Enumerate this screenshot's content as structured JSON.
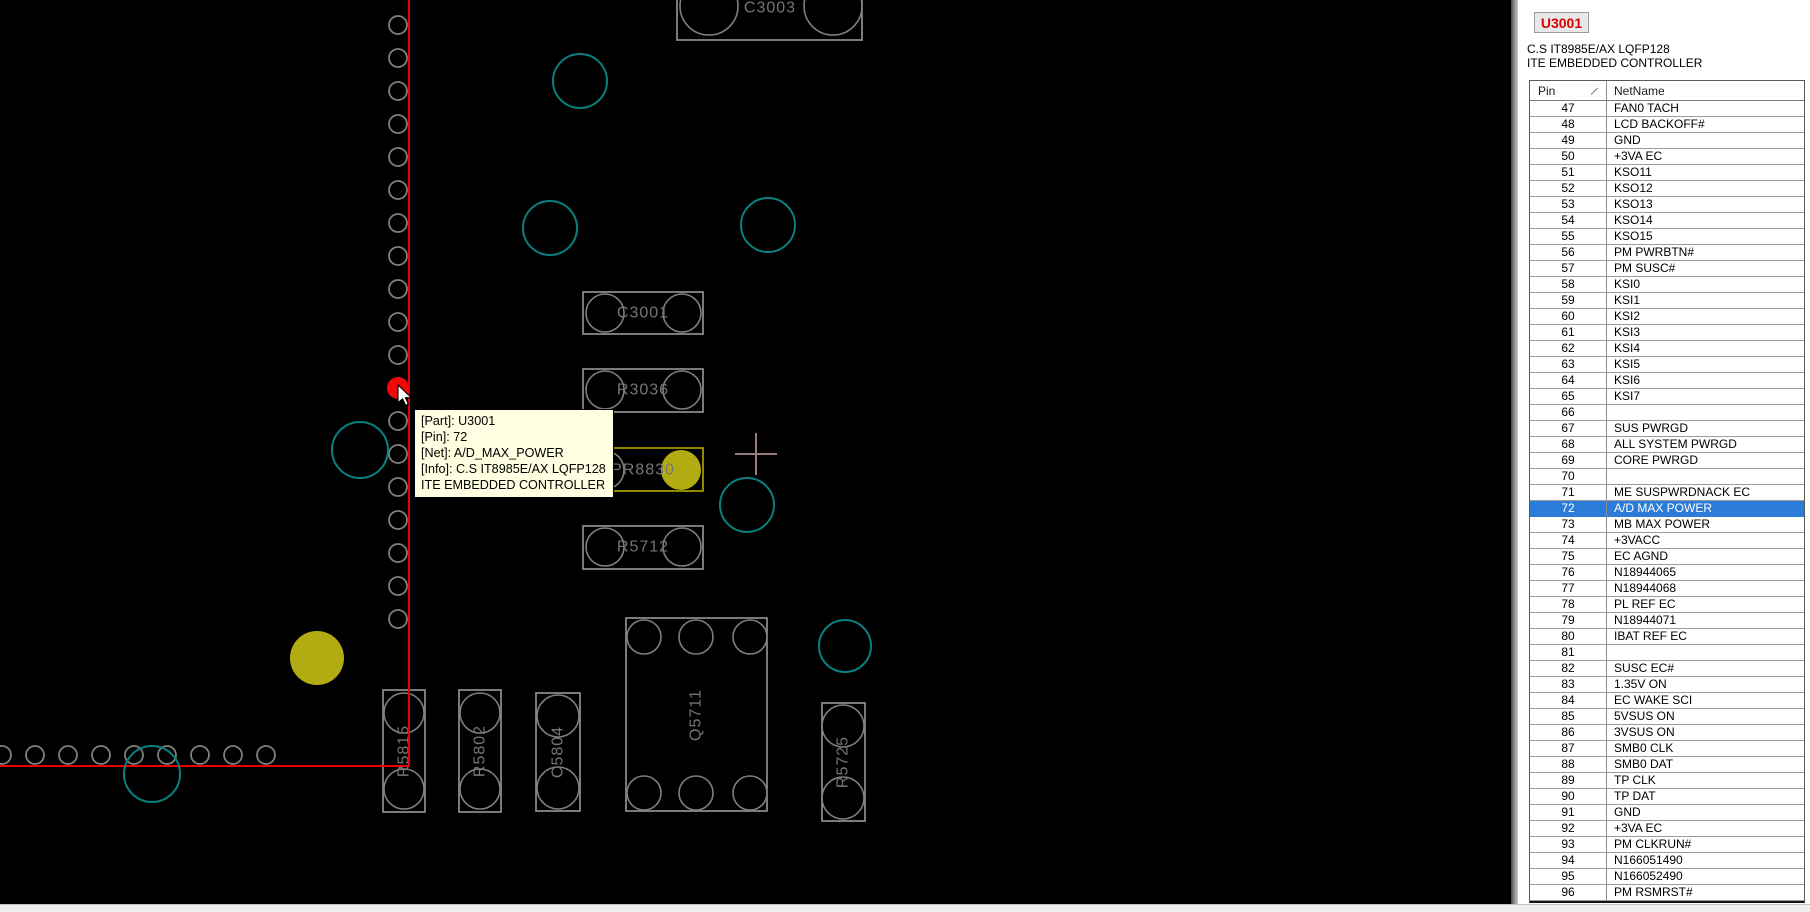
{
  "tooltip": {
    "lines": [
      "[Part]: U3001",
      "[Pin]: 72",
      "[Net]: A/D_MAX_POWER",
      "[Info]: C.S IT8985E/AX LQFP128",
      "ITE EMBEDDED CONTROLLER"
    ]
  },
  "panel": {
    "part_button_label": "U3001",
    "part_info": [
      "C.S IT8985E/AX LQFP128",
      "ITE EMBEDDED CONTROLLER"
    ],
    "table": {
      "columns": [
        "Pin",
        "NetName"
      ],
      "selected_pin": "72",
      "selection_color": "#2b7bd8",
      "rows": [
        {
          "pin": "47",
          "net": "FAN0 TACH"
        },
        {
          "pin": "48",
          "net": "LCD BACKOFF#"
        },
        {
          "pin": "49",
          "net": "GND"
        },
        {
          "pin": "50",
          "net": "+3VA EC"
        },
        {
          "pin": "51",
          "net": "KSO11"
        },
        {
          "pin": "52",
          "net": "KSO12"
        },
        {
          "pin": "53",
          "net": "KSO13"
        },
        {
          "pin": "54",
          "net": "KSO14"
        },
        {
          "pin": "55",
          "net": "KSO15"
        },
        {
          "pin": "56",
          "net": "PM PWRBTN#"
        },
        {
          "pin": "57",
          "net": "PM SUSC#"
        },
        {
          "pin": "58",
          "net": "KSI0"
        },
        {
          "pin": "59",
          "net": "KSI1"
        },
        {
          "pin": "60",
          "net": "KSI2"
        },
        {
          "pin": "61",
          "net": "KSI3"
        },
        {
          "pin": "62",
          "net": "KSI4"
        },
        {
          "pin": "63",
          "net": "KSI5"
        },
        {
          "pin": "64",
          "net": "KSI6"
        },
        {
          "pin": "65",
          "net": "KSI7"
        },
        {
          "pin": "66",
          "net": ""
        },
        {
          "pin": "67",
          "net": "SUS PWRGD"
        },
        {
          "pin": "68",
          "net": "ALL SYSTEM PWRGD"
        },
        {
          "pin": "69",
          "net": "CORE PWRGD"
        },
        {
          "pin": "70",
          "net": ""
        },
        {
          "pin": "71",
          "net": "ME SUSPWRDNACK EC"
        },
        {
          "pin": "72",
          "net": "A/D MAX POWER"
        },
        {
          "pin": "73",
          "net": "MB MAX POWER"
        },
        {
          "pin": "74",
          "net": "+3VACC"
        },
        {
          "pin": "75",
          "net": "EC AGND"
        },
        {
          "pin": "76",
          "net": "N18944065"
        },
        {
          "pin": "77",
          "net": "N18944068"
        },
        {
          "pin": "78",
          "net": "PL REF EC"
        },
        {
          "pin": "79",
          "net": "N18944071"
        },
        {
          "pin": "80",
          "net": "IBAT REF EC"
        },
        {
          "pin": "81",
          "net": ""
        },
        {
          "pin": "82",
          "net": "SUSC EC#"
        },
        {
          "pin": "83",
          "net": "1.35V ON"
        },
        {
          "pin": "84",
          "net": "EC WAKE SCI"
        },
        {
          "pin": "85",
          "net": "5VSUS ON"
        },
        {
          "pin": "86",
          "net": "3VSUS ON"
        },
        {
          "pin": "87",
          "net": "SMB0 CLK"
        },
        {
          "pin": "88",
          "net": "SMB0 DAT"
        },
        {
          "pin": "89",
          "net": "TP CLK"
        },
        {
          "pin": "90",
          "net": "TP DAT"
        },
        {
          "pin": "91",
          "net": "GND"
        },
        {
          "pin": "92",
          "net": "+3VA EC"
        },
        {
          "pin": "93",
          "net": "PM CLKRUN#"
        },
        {
          "pin": "94",
          "net": "N166051490"
        },
        {
          "pin": "95",
          "net": "N166052490"
        },
        {
          "pin": "96",
          "net": "PM RSMRST#"
        }
      ]
    }
  },
  "board": {
    "colors": {
      "bg": "#000000",
      "pad": "#7f7f7f",
      "outline": "#8f8f8f",
      "label": "#767676",
      "via": "#0a8080",
      "red": "#e60000",
      "red_dot": "#ee0a0a",
      "yellow": "#b3ab12",
      "yellow_outline": "#a6a000",
      "crosshair": "#9a7b7b"
    },
    "components": [
      {
        "ref": "C3003",
        "x": 677,
        "y": -25,
        "w": 185,
        "h": 65,
        "rot": 0,
        "label": [
          770,
          8
        ],
        "pads": [
          [
            709,
            6,
            29
          ],
          [
            833,
            6,
            29
          ]
        ]
      },
      {
        "ref": "C3001",
        "x": 583,
        "y": 292,
        "w": 120,
        "h": 42,
        "rot": 0,
        "label": [
          643,
          313
        ],
        "pads": [
          [
            605,
            313,
            19
          ],
          [
            682,
            313,
            19
          ]
        ]
      },
      {
        "ref": "R3036",
        "x": 583,
        "y": 369,
        "w": 120,
        "h": 43,
        "rot": 0,
        "label": [
          643,
          390
        ],
        "pads": [
          [
            605,
            390,
            19
          ],
          [
            682,
            390,
            19
          ]
        ]
      },
      {
        "ref": "PR8830",
        "x": 583,
        "y": 448,
        "w": 120,
        "h": 43,
        "rot": 0,
        "label": [
          643,
          470
        ],
        "highlight": true,
        "pads": [
          [
            605,
            470,
            19
          ],
          [
            681,
            470,
            20,
            "y"
          ]
        ]
      },
      {
        "ref": "R5712",
        "x": 583,
        "y": 526,
        "w": 120,
        "h": 43,
        "rot": 0,
        "label": [
          643,
          547
        ],
        "pads": [
          [
            605,
            547,
            19
          ],
          [
            682,
            547,
            19
          ]
        ]
      },
      {
        "ref": "Q5711",
        "x": 626,
        "y": 618,
        "w": 141,
        "h": 193,
        "rot": -90,
        "label": [
          696,
          715
        ],
        "pads": [
          [
            644,
            637,
            17
          ],
          [
            696,
            637,
            17
          ],
          [
            750,
            637,
            17
          ],
          [
            644,
            793,
            17
          ],
          [
            696,
            793,
            17
          ],
          [
            750,
            793,
            17
          ]
        ]
      },
      {
        "ref": "R5815",
        "x": 383,
        "y": 690,
        "w": 42,
        "h": 122,
        "rot": -90,
        "label": [
          404,
          751
        ],
        "pads": [
          [
            404,
            713,
            20
          ],
          [
            404,
            789,
            20
          ]
        ]
      },
      {
        "ref": "R5802",
        "x": 459,
        "y": 690,
        "w": 42,
        "h": 122,
        "rot": -90,
        "label": [
          480,
          751
        ],
        "pads": [
          [
            480,
            713,
            20
          ],
          [
            480,
            789,
            20
          ]
        ]
      },
      {
        "ref": "C5804",
        "x": 536,
        "y": 693,
        "w": 44,
        "h": 118,
        "rot": -90,
        "label": [
          558,
          752
        ],
        "pads": [
          [
            558,
            716,
            21
          ],
          [
            558,
            788,
            21
          ]
        ]
      },
      {
        "ref": "R5725",
        "x": 822,
        "y": 703,
        "w": 43,
        "h": 118,
        "rot": -90,
        "label": [
          843,
          762
        ],
        "pads": [
          [
            843,
            726,
            21
          ],
          [
            843,
            798,
            21
          ]
        ]
      }
    ],
    "pad_column": {
      "x": 398,
      "y0": 25,
      "dy": 33,
      "n": 19,
      "r": 9,
      "red_index": 11
    },
    "pad_row": {
      "y": 755,
      "x0": 2,
      "dx": 33,
      "n": 9,
      "r": 9
    },
    "red_lines": [
      [
        409,
        0,
        409,
        766
      ],
      [
        0,
        766,
        409,
        766
      ]
    ],
    "vias": [
      [
        580,
        81,
        27
      ],
      [
        550,
        228,
        27
      ],
      [
        768,
        225,
        27
      ],
      [
        360,
        450,
        28
      ],
      [
        747,
        505,
        27
      ],
      [
        845,
        646,
        26
      ],
      [
        152,
        774,
        28
      ]
    ],
    "yellow_dots": [
      [
        317,
        658,
        27
      ]
    ],
    "crosshair": {
      "x": 756,
      "y": 454,
      "arm": 21
    }
  }
}
